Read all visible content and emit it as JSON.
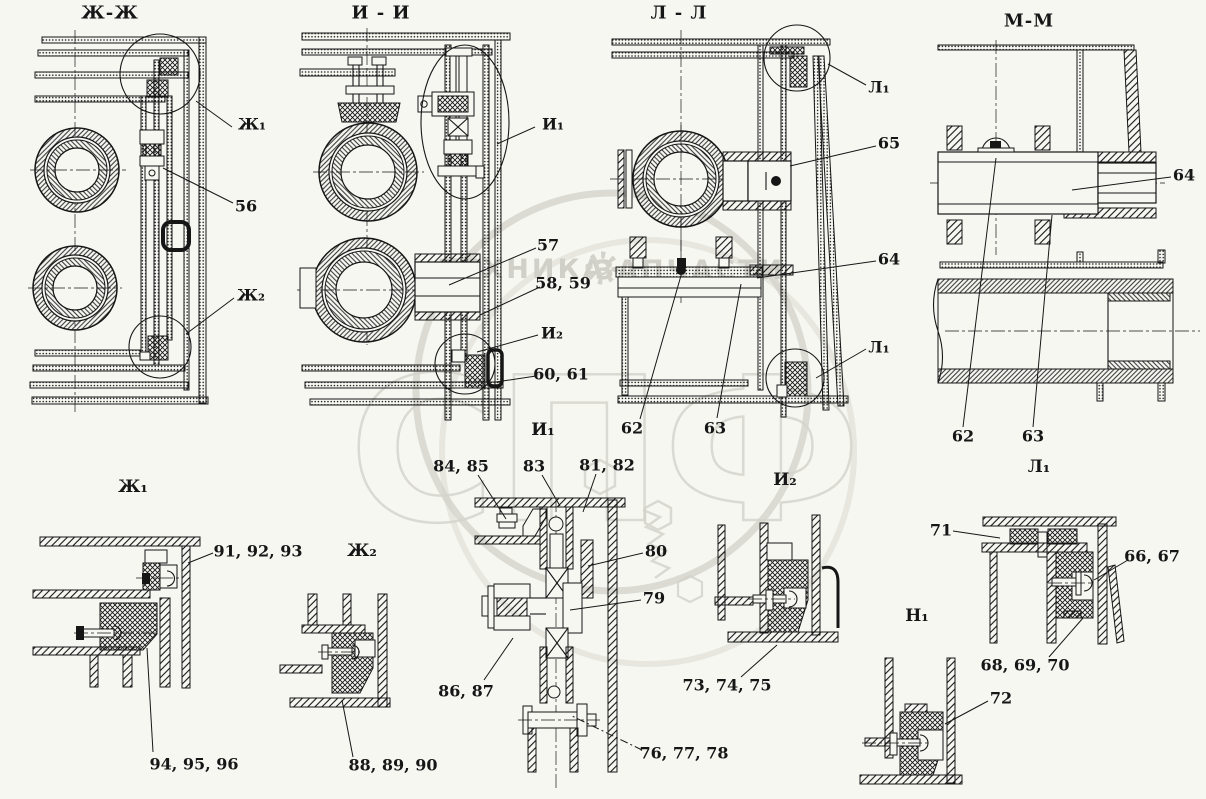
{
  "drawing": {
    "background": "#f7f7f2",
    "ink": "#161616",
    "watermark": {
      "brand_left": "ТЕХНИКА",
      "brand_right": "ЗАПЧАСТИ",
      "logo_text": "СПФ",
      "color": "#d2d2ca"
    },
    "labels": [
      {
        "id": "section-title-zh-zh",
        "text": "Ж-Ж",
        "x": 110,
        "y": 13,
        "kind": "title"
      },
      {
        "id": "section-title-i-i",
        "text": "И - И",
        "x": 381,
        "y": 13,
        "kind": "title"
      },
      {
        "id": "section-title-l-l",
        "text": "Л - Л",
        "x": 679,
        "y": 13,
        "kind": "title"
      },
      {
        "id": "section-title-m-m",
        "text": "М-М",
        "x": 1029,
        "y": 21,
        "kind": "title"
      },
      {
        "id": "callout-zh1",
        "text": "Ж₁",
        "x": 252,
        "y": 124,
        "kind": "callout"
      },
      {
        "id": "part-56",
        "text": "56",
        "x": 246,
        "y": 206,
        "kind": "callout"
      },
      {
        "id": "callout-zh2",
        "text": "Ж₂",
        "x": 251,
        "y": 295,
        "kind": "callout"
      },
      {
        "id": "callout-i1",
        "text": "И₁",
        "x": 553,
        "y": 124,
        "kind": "callout"
      },
      {
        "id": "part-57",
        "text": "57",
        "x": 548,
        "y": 245,
        "kind": "callout"
      },
      {
        "id": "part-58-59",
        "text": "58, 59",
        "x": 563,
        "y": 283,
        "kind": "callout"
      },
      {
        "id": "callout-i2",
        "text": "И₂",
        "x": 552,
        "y": 333,
        "kind": "callout"
      },
      {
        "id": "part-60-61",
        "text": "60, 61",
        "x": 561,
        "y": 374,
        "kind": "callout"
      },
      {
        "id": "detail-title-i1",
        "text": "И₁",
        "x": 543,
        "y": 430,
        "kind": "sub"
      },
      {
        "id": "callout-l1-top",
        "text": "Л₁",
        "x": 879,
        "y": 87,
        "kind": "callout"
      },
      {
        "id": "part-65",
        "text": "65",
        "x": 889,
        "y": 143,
        "kind": "callout"
      },
      {
        "id": "part-64-l",
        "text": "64",
        "x": 889,
        "y": 259,
        "kind": "callout"
      },
      {
        "id": "callout-l1-bottom",
        "text": "Л₁",
        "x": 879,
        "y": 347,
        "kind": "callout"
      },
      {
        "id": "part-62-l",
        "text": "62",
        "x": 632,
        "y": 428,
        "kind": "callout"
      },
      {
        "id": "part-63-l",
        "text": "63",
        "x": 715,
        "y": 428,
        "kind": "callout"
      },
      {
        "id": "detail-title-i2",
        "text": "И₂",
        "x": 785,
        "y": 480,
        "kind": "sub"
      },
      {
        "id": "part-64-m",
        "text": "64",
        "x": 1184,
        "y": 175,
        "kind": "callout"
      },
      {
        "id": "part-62-m",
        "text": "62",
        "x": 963,
        "y": 436,
        "kind": "callout"
      },
      {
        "id": "part-63-m",
        "text": "63",
        "x": 1033,
        "y": 436,
        "kind": "callout"
      },
      {
        "id": "detail-title-l1",
        "text": "Л₁",
        "x": 1039,
        "y": 467,
        "kind": "sub"
      },
      {
        "id": "detail-title-zh1",
        "text": "Ж₁",
        "x": 133,
        "y": 487,
        "kind": "sub"
      },
      {
        "id": "part-91-92-93",
        "text": "91, 92, 93",
        "x": 258,
        "y": 551,
        "kind": "callout"
      },
      {
        "id": "part-94-95-96",
        "text": "94, 95, 96",
        "x": 194,
        "y": 764,
        "kind": "callout"
      },
      {
        "id": "detail-title-zh2",
        "text": "Ж₂",
        "x": 362,
        "y": 551,
        "kind": "sub"
      },
      {
        "id": "part-88-89-90",
        "text": "88, 89, 90",
        "x": 393,
        "y": 765,
        "kind": "callout"
      },
      {
        "id": "part-84-85",
        "text": "84, 85",
        "x": 461,
        "y": 466,
        "kind": "callout"
      },
      {
        "id": "part-83",
        "text": "83",
        "x": 534,
        "y": 466,
        "kind": "callout"
      },
      {
        "id": "part-81-82",
        "text": "81, 82",
        "x": 607,
        "y": 465,
        "kind": "callout"
      },
      {
        "id": "part-80",
        "text": "80",
        "x": 656,
        "y": 551,
        "kind": "callout"
      },
      {
        "id": "part-79",
        "text": "79",
        "x": 654,
        "y": 598,
        "kind": "callout"
      },
      {
        "id": "part-86-87",
        "text": "86, 87",
        "x": 466,
        "y": 691,
        "kind": "callout"
      },
      {
        "id": "part-76-77-78",
        "text": "76, 77, 78",
        "x": 684,
        "y": 753,
        "kind": "callout"
      },
      {
        "id": "part-73-74-75",
        "text": "73, 74, 75",
        "x": 727,
        "y": 685,
        "kind": "callout"
      },
      {
        "id": "part-71",
        "text": "71",
        "x": 941,
        "y": 530,
        "kind": "callout"
      },
      {
        "id": "part-66-67",
        "text": "66, 67",
        "x": 1152,
        "y": 556,
        "kind": "callout"
      },
      {
        "id": "part-68-69-70",
        "text": "68, 69, 70",
        "x": 1025,
        "y": 665,
        "kind": "callout"
      },
      {
        "id": "detail-title-n1",
        "text": "Н₁",
        "x": 917,
        "y": 616,
        "kind": "sub"
      },
      {
        "id": "part-72",
        "text": "72",
        "x": 1001,
        "y": 698,
        "kind": "callout"
      }
    ]
  }
}
